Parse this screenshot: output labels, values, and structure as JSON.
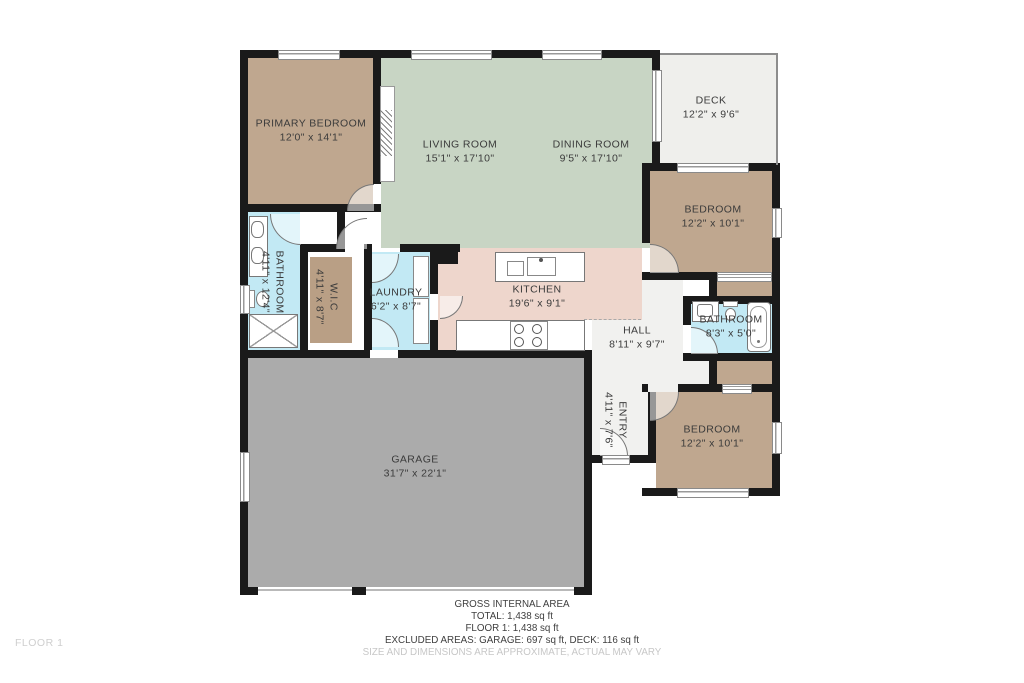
{
  "title": "Floor plan - Floor 1",
  "palette": {
    "wall": "#1a1a1a",
    "bedroom_tan": "#bfa78f",
    "wic_tan": "#b99f85",
    "living_green": "#c8d5c4",
    "kitchen_pink": "#eed6cc",
    "bath_blue": "#c2e9f4",
    "garage_gray": "#ababab",
    "hall_gray": "#f1f1ef",
    "deck_gray": "#efefec",
    "label_text": "#3b3b3b"
  },
  "rooms": [
    {
      "id": "primary-bedroom",
      "name": "PRIMARY BEDROOM",
      "dims": "12'0\" x 14'1\""
    },
    {
      "id": "living-room",
      "name": "LIVING ROOM",
      "dims": "15'1\" x 17'10\""
    },
    {
      "id": "dining-room",
      "name": "DINING ROOM",
      "dims": "9'5\" x 17'10\""
    },
    {
      "id": "deck",
      "name": "DECK",
      "dims": "12'2\" x 9'6\""
    },
    {
      "id": "bedroom-top",
      "name": "BEDROOM",
      "dims": "12'2\" x 10'1\""
    },
    {
      "id": "bathroom-left",
      "name": "BATHROOM",
      "dims": "4'11\" x 12'4\""
    },
    {
      "id": "wic",
      "name": "W.I.C",
      "dims": "4'11\" x 8'7\""
    },
    {
      "id": "laundry",
      "name": "LAUNDRY",
      "dims": "6'2\" x 8'7\""
    },
    {
      "id": "kitchen",
      "name": "KITCHEN",
      "dims": "19'6\" x 9'1\""
    },
    {
      "id": "hall",
      "name": "HALL",
      "dims": "8'11\" x 9'7\""
    },
    {
      "id": "bathroom-right",
      "name": "BATHROOM",
      "dims": "8'3\" x 5'0\""
    },
    {
      "id": "entry",
      "name": "ENTRY",
      "dims": "4'11\" x 7'6\""
    },
    {
      "id": "bedroom-bottom",
      "name": "BEDROOM",
      "dims": "12'2\" x 10'1\""
    },
    {
      "id": "garage",
      "name": "GARAGE",
      "dims": "31'7\" x 22'1\""
    }
  ],
  "footer": {
    "line1": "GROSS INTERNAL AREA",
    "line2": "TOTAL: 1,438 sq ft",
    "line3": "FLOOR 1: 1,438 sq ft",
    "line4": "EXCLUDED AREAS: GARAGE: 697 sq ft, DECK: 116 sq ft",
    "disclaimer": "SIZE AND DIMENSIONS ARE APPROXIMATE, ACTUAL MAY VARY"
  },
  "floor_label": "FLOOR 1"
}
